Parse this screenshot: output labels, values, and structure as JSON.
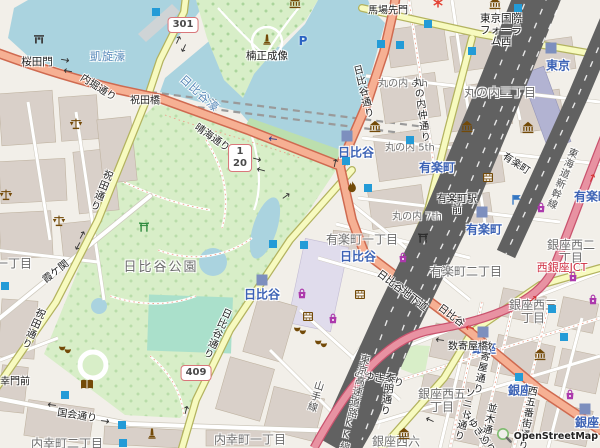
{
  "map": {
    "attribution": "OpenStreetMap",
    "colors": {
      "land": "#f2efe9",
      "water": "#aad3df",
      "park": "#d8eec8",
      "pitch": "#aae0cb",
      "bank": "#bcdfae",
      "building": "#d9d0c9",
      "buildingStroke": "#c0b4a2",
      "road": "#ffffff",
      "roadCasing": "#cdc8bc",
      "secondary": "#f7fabf",
      "secondaryCasing": "#b3b35f",
      "trunk": "#f6b093",
      "trunkCasing": "#cf6a50",
      "motorway": "#e892a2",
      "motorwayCasing": "#c9536e",
      "rail": "#616161",
      "station": "#7d8fbe",
      "entrance": "#239bd7",
      "poiBrown": "#734a08",
      "shopPurple": "#ac39ac",
      "police": "#3476c2",
      "placeLabel": "#6e6e6e",
      "roadLabel": "#1f1f1f",
      "stationLabel": "#3c62b5",
      "waterLabel": "#5687b8",
      "junctionLabel": "#cf2e41",
      "railLabel": "#4f4f4f"
    },
    "shields": [
      {
        "refs": [
          "301"
        ],
        "x": 183,
        "y": 25
      },
      {
        "refs": [
          "1",
          "20"
        ],
        "x": 240,
        "y": 158
      },
      {
        "refs": [
          "409"
        ],
        "x": 196,
        "y": 373
      }
    ],
    "labels": [
      {
        "t": "凱旋濠",
        "cls": "waterlbl",
        "x": 108,
        "y": 57
      },
      {
        "t": "日比谷濠",
        "cls": "waterlbl",
        "x": 199,
        "y": 94,
        "rot": 42
      },
      {
        "t": "丸の内三丁目",
        "cls": "place",
        "x": 500,
        "y": 93
      },
      {
        "t": "有楽町一丁目",
        "cls": "place",
        "x": 362,
        "y": 240
      },
      {
        "t": "有楽町二丁目",
        "cls": "place",
        "x": 466,
        "y": 272
      },
      {
        "t": "内幸町一丁目",
        "cls": "place",
        "x": 250,
        "y": 440
      },
      {
        "t": "内幸町二丁目",
        "cls": "place",
        "x": 67,
        "y": 444
      },
      {
        "t": "銀座西二\n丁目",
        "cls": "place",
        "x": 571,
        "y": 252
      },
      {
        "t": "銀座西三\n丁目",
        "cls": "place",
        "x": 533,
        "y": 312
      },
      {
        "t": "銀座西五\n丁目",
        "cls": "place",
        "x": 442,
        "y": 401
      },
      {
        "t": "銀座西六",
        "cls": "place",
        "x": 396,
        "y": 442
      },
      {
        "t": "一丁目",
        "cls": "place",
        "x": 14,
        "y": 264
      },
      {
        "t": "日比谷公園",
        "cls": "place park-name",
        "x": 161,
        "y": 268
      },
      {
        "t": "丸の内 4th",
        "cls": "place small",
        "x": 403,
        "y": 84
      },
      {
        "t": "丸の内 5th",
        "cls": "place small",
        "x": 410,
        "y": 148
      },
      {
        "t": "丸の内 7th",
        "cls": "place small",
        "x": 417,
        "y": 217
      },
      {
        "t": "日比谷",
        "cls": "station",
        "x": 356,
        "y": 153
      },
      {
        "t": "日比谷",
        "cls": "station",
        "x": 262,
        "y": 295
      },
      {
        "t": "日比谷",
        "cls": "station",
        "x": 358,
        "y": 257
      },
      {
        "t": "有楽町",
        "cls": "station",
        "x": 437,
        "y": 168
      },
      {
        "t": "有楽町",
        "cls": "station",
        "x": 484,
        "y": 230
      },
      {
        "t": "有楽町",
        "cls": "station",
        "x": 592,
        "y": 197
      },
      {
        "t": "東京",
        "cls": "station",
        "x": 558,
        "y": 66
      },
      {
        "t": "銀座",
        "cls": "station",
        "x": 484,
        "y": 349
      },
      {
        "t": "銀座",
        "cls": "station",
        "x": 520,
        "y": 391
      },
      {
        "t": "銀座",
        "cls": "station",
        "x": 587,
        "y": 423
      },
      {
        "t": "内堀通り",
        "cls": "road",
        "x": 98,
        "y": 88,
        "rot": 33
      },
      {
        "t": "祝田橋",
        "cls": "road",
        "x": 145,
        "y": 101
      },
      {
        "t": "祝田通り",
        "cls": "road vert",
        "x": 100,
        "y": 190,
        "rot": 22
      },
      {
        "t": "祝田通り",
        "cls": "road vert",
        "x": 32,
        "y": 328,
        "rot": 24
      },
      {
        "t": "晴海通り",
        "cls": "road",
        "x": 212,
        "y": 138,
        "rot": 35
      },
      {
        "t": "日比谷通り",
        "cls": "road vert",
        "x": 362,
        "y": 92,
        "rot": -14
      },
      {
        "t": "日比谷通り",
        "cls": "road vert",
        "x": 216,
        "y": 333,
        "rot": 24
      },
      {
        "t": "日比谷地下道",
        "cls": "road",
        "x": 402,
        "y": 291,
        "rot": 37
      },
      {
        "t": "日比谷",
        "cls": "road",
        "x": 451,
        "y": 316,
        "rot": 37
      },
      {
        "t": "馬場先門",
        "cls": "road",
        "x": 388,
        "y": 11
      },
      {
        "t": "丸の内仲通り",
        "cls": "road vert",
        "x": 420,
        "y": 110,
        "rot": -8
      },
      {
        "t": "有楽町駅\n前",
        "cls": "road",
        "x": 457,
        "y": 205
      },
      {
        "t": "有楽町",
        "cls": "road",
        "x": 516,
        "y": 164,
        "rot": 33
      },
      {
        "t": "霞ケ関",
        "cls": "road",
        "x": 56,
        "y": 272,
        "rot": -38
      },
      {
        "t": "国会通り",
        "cls": "road",
        "x": 77,
        "y": 416,
        "rot": 9
      },
      {
        "t": "幸門前",
        "cls": "road",
        "x": 15,
        "y": 382
      },
      {
        "t": "みゆき通り",
        "cls": "road",
        "x": 379,
        "y": 379,
        "rot": 12
      },
      {
        "t": "みゆき通り",
        "cls": "road",
        "x": 478,
        "y": 432,
        "rot": 55
      },
      {
        "t": "泰明通り",
        "cls": "road vert",
        "x": 386,
        "y": 394,
        "rot": 8
      },
      {
        "t": "数寄屋通り",
        "cls": "road vert",
        "x": 481,
        "y": 367,
        "rot": 12
      },
      {
        "t": "ソニー通り",
        "cls": "road vert",
        "x": 463,
        "y": 414,
        "rot": 14
      },
      {
        "t": "並木通り",
        "cls": "road vert",
        "x": 487,
        "y": 424,
        "rot": 12
      },
      {
        "t": "西五番街通り",
        "cls": "road vert",
        "x": 526,
        "y": 418,
        "rot": 10
      },
      {
        "t": "数寄屋橋",
        "cls": "road",
        "x": 468,
        "y": 347
      },
      {
        "t": "山手線",
        "cls": "raillbl vert",
        "x": 314,
        "y": 396,
        "rot": 17
      },
      {
        "t": "東海道新幹線",
        "cls": "raillbl vert",
        "x": 561,
        "y": 178,
        "rot": 22
      },
      {
        "t": "東京高速道路KK線",
        "cls": "raillbl vert",
        "x": 353,
        "y": 403,
        "rot": 13
      },
      {
        "t": "西銀座JCT",
        "cls": "junction",
        "x": 562,
        "y": 268
      },
      {
        "t": "桜田門",
        "cls": "poi",
        "x": 37,
        "y": 63
      },
      {
        "t": "楠正成像",
        "cls": "poi",
        "x": 267,
        "y": 57
      },
      {
        "t": "東京国際\nフォーラ\nム西",
        "cls": "poi",
        "x": 501,
        "y": 31
      }
    ],
    "icons": [
      {
        "n": "museum-icon",
        "x": 295,
        "y": 3
      },
      {
        "n": "museum-icon",
        "x": 495,
        "y": 4
      },
      {
        "n": "museum-icon",
        "x": 375,
        "y": 127
      },
      {
        "n": "museum-icon",
        "x": 467,
        "y": 127
      },
      {
        "n": "museum-icon",
        "x": 528,
        "y": 128
      },
      {
        "n": "museum-icon",
        "x": 540,
        "y": 355
      },
      {
        "n": "museum-icon",
        "x": 404,
        "y": 434
      },
      {
        "n": "scales-icon",
        "x": 76,
        "y": 125
      },
      {
        "n": "scales-icon",
        "x": 59,
        "y": 222
      },
      {
        "n": "scales-icon",
        "x": 6,
        "y": 196
      },
      {
        "n": "cinema-icon",
        "x": 488,
        "y": 178
      },
      {
        "n": "cinema-icon",
        "x": 360,
        "y": 295
      },
      {
        "n": "cinema-icon",
        "x": 308,
        "y": 317
      },
      {
        "n": "theatre-icon",
        "x": 300,
        "y": 331
      },
      {
        "n": "theatre-icon",
        "x": 321,
        "y": 344
      },
      {
        "n": "theatre-icon",
        "x": 65,
        "y": 350
      },
      {
        "n": "shop-icon",
        "x": 302,
        "y": 294
      },
      {
        "n": "shop-icon",
        "x": 333,
        "y": 319
      },
      {
        "n": "shop-icon",
        "x": 403,
        "y": 258
      },
      {
        "n": "shop-icon",
        "x": 541,
        "y": 208
      },
      {
        "n": "shop-icon",
        "x": 573,
        "y": 277
      },
      {
        "n": "shop-icon",
        "x": 593,
        "y": 300
      },
      {
        "n": "shop-icon",
        "x": 570,
        "y": 395
      },
      {
        "n": "library-icon",
        "x": 87,
        "y": 385
      },
      {
        "n": "monument-icon",
        "x": 267,
        "y": 40
      },
      {
        "n": "monument-icon",
        "x": 152,
        "y": 434
      },
      {
        "n": "gate-icon",
        "x": 39,
        "y": 39
      },
      {
        "n": "torii-green-icon",
        "x": 144,
        "y": 227
      },
      {
        "n": "torii-icon",
        "x": 423,
        "y": 238
      },
      {
        "n": "fire-icon",
        "x": 352,
        "y": 188
      },
      {
        "n": "parking-icon",
        "x": 303,
        "y": 41
      },
      {
        "n": "police-icon",
        "x": 517,
        "y": 200
      },
      {
        "n": "attraction-icon",
        "x": 438,
        "y": 3
      }
    ],
    "subway_entrances": [
      [
        156,
        12
      ],
      [
        381,
        44
      ],
      [
        518,
        8
      ],
      [
        428,
        24
      ],
      [
        400,
        45
      ],
      [
        472,
        51
      ],
      [
        346,
        161
      ],
      [
        410,
        140
      ],
      [
        368,
        188
      ],
      [
        273,
        244
      ],
      [
        304,
        245
      ],
      [
        65,
        395
      ],
      [
        122,
        425
      ],
      [
        123,
        443
      ],
      [
        552,
        309
      ],
      [
        564,
        337
      ],
      [
        519,
        377
      ],
      [
        5,
        286
      ]
    ],
    "station_markers": [
      [
        551,
        48
      ],
      [
        347,
        136
      ],
      [
        482,
        212
      ],
      [
        483,
        332
      ],
      [
        585,
        409
      ],
      [
        262,
        280
      ]
    ],
    "oneway_arrows": [
      {
        "x": 65,
        "y": 60,
        "rot": 10
      },
      {
        "x": 68,
        "y": 71,
        "rot": 190
      },
      {
        "x": 178,
        "y": 40,
        "rot": -65
      },
      {
        "x": 184,
        "y": 48,
        "rot": 115
      },
      {
        "x": 257,
        "y": 159,
        "rot": 15
      },
      {
        "x": 261,
        "y": 170,
        "rot": 195
      },
      {
        "x": 335,
        "y": 163,
        "rot": -78
      },
      {
        "x": 286,
        "y": 196,
        "rot": -35
      },
      {
        "x": 82,
        "y": 235,
        "rot": -62
      },
      {
        "x": 78,
        "y": 246,
        "rot": 118
      },
      {
        "x": 186,
        "y": 410,
        "rot": -75
      },
      {
        "x": 52,
        "y": 405,
        "rot": 188
      },
      {
        "x": 105,
        "y": 421,
        "rot": 8
      },
      {
        "x": 440,
        "y": 340,
        "rot": 188
      },
      {
        "x": 430,
        "y": 420,
        "rot": 205
      },
      {
        "x": 273,
        "y": 139,
        "rot": 188,
        "color": "navy"
      },
      {
        "x": 592,
        "y": 178,
        "rot": -65,
        "color": "red"
      },
      {
        "x": 470,
        "y": 328,
        "rot": 188,
        "color": "red"
      },
      {
        "x": 533,
        "y": 299,
        "rot": -35,
        "color": "red"
      }
    ]
  }
}
